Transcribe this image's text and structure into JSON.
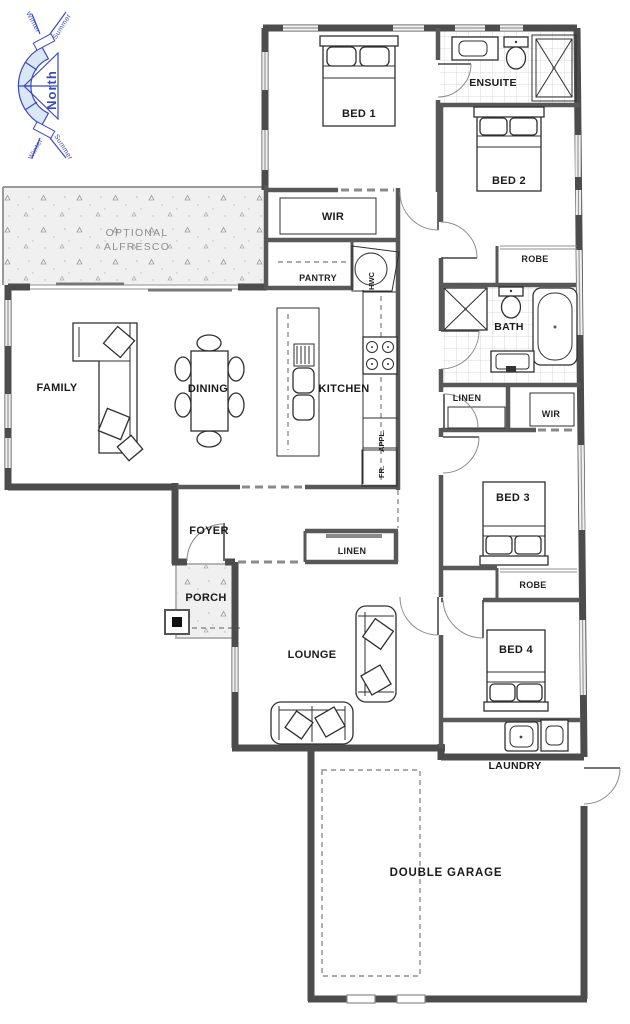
{
  "colors": {
    "wall": "#4c4c4c",
    "wall2": "#585858",
    "label": "#1b1b1b",
    "muted": "#8f8f8f",
    "compass": "#3a49c1",
    "compassfill": "#d9e7f6",
    "tile": "#cfcfcf",
    "speckle_bg": "#f0f0f0"
  },
  "compass": {
    "north": "North",
    "winter": "Winter",
    "summer": "Summer"
  },
  "plan": {
    "alfresco": {
      "line1": "OPTIONAL",
      "line2": "ALFRESCO"
    },
    "rooms": {
      "bed1": "BED 1",
      "ensuite": "ENSUITE",
      "bed2": "BED 2",
      "wir_master": "WIR",
      "robe_bed2": "ROBE",
      "pantry": "PANTRY",
      "hwc": "HWC",
      "bath": "BATH",
      "family": "FAMILY",
      "dining": "DINING",
      "kitchen": "KITCHEN",
      "linen_hall": "LINEN",
      "wir_bed3": "WIR",
      "appl": "APPL.",
      "fridge": "FR.",
      "bed3": "BED 3",
      "foyer": "FOYER",
      "linen_entry": "LINEN",
      "porch": "PORCH",
      "robe_bed3": "ROBE",
      "lounge": "LOUNGE",
      "bed4": "BED 4",
      "laundry": "LAUNDRY",
      "garage": "DOUBLE GARAGE"
    }
  }
}
